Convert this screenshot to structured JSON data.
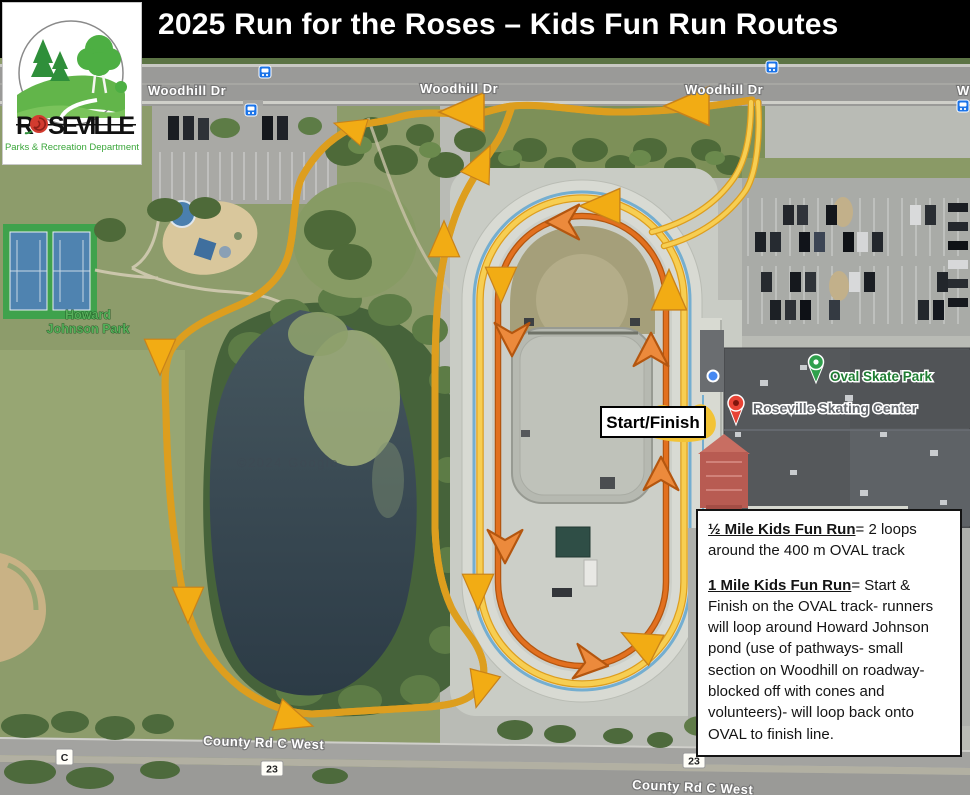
{
  "title_bar": {
    "title": "2025 Run for the Roses – Kids Fun Run Routes",
    "bg": "#000000",
    "fg": "#ffffff"
  },
  "logo": {
    "word_initial": "R",
    "word_rest": "SEVILLE",
    "tagline": "Parks & Recreation Department"
  },
  "map": {
    "streets": {
      "woodhill": "Woodhill Dr",
      "woodhill_partial": "W",
      "county": "County Rd C West"
    },
    "badges": {
      "county_letter": "C",
      "highway": "23"
    },
    "park_label": {
      "line1": "Howard",
      "line2": "Johnson Park"
    },
    "pois": {
      "skate_park": "Oval Skate Park",
      "skating_center": "Roseville Skating Center"
    },
    "watermark": "©2024 Google",
    "start_finish_label": "Start/Finish"
  },
  "routes": {
    "one_mile": {
      "name": "1 Mile Kids Fun Run route",
      "color": "#F5C542"
    },
    "half_mile": {
      "name": "½ Mile Kids Fun Run route",
      "color": "#E2701F"
    }
  },
  "info_box": {
    "half_mile_lead": "½ Mile Kids Fun Run",
    "half_mile_rest": "= 2 loops around the 400 m OVAL track",
    "one_mile_lead": "1 Mile Kids Fun Run",
    "one_mile_rest": "= Start & Finish on the OVAL track- runners will loop around Howard Johnson pond (use of pathways- small section on Woodhill on roadway- blocked off with cones and volunteers)- will loop back onto OVAL to finish line."
  },
  "icons": {
    "bus_stop": "bus-stop-icon",
    "park_pin": "green-park-pin-icon",
    "place_pin": "red-place-pin-icon",
    "location_dot": "blue-location-dot-icon"
  }
}
